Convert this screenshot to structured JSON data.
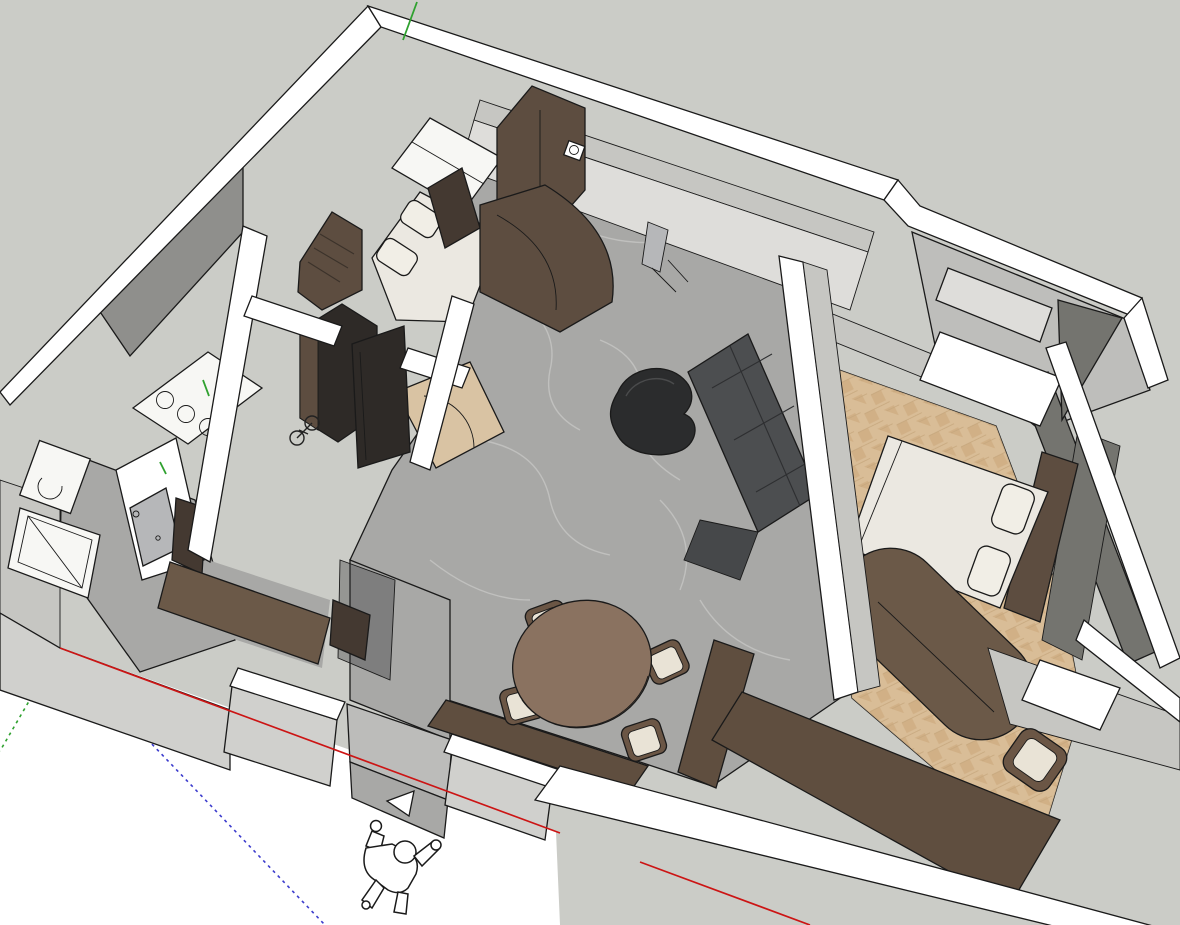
{
  "app": {
    "kind": "3d-modeling-viewport",
    "view": "top-down perspective of apartment interior model",
    "visible_text": ""
  },
  "palette": {
    "background": "#ffffff",
    "ground": "#cbccc7",
    "wallTop": "#ffffff",
    "wallFaceLight": "#deddda",
    "wallFaceMid": "#c6c6c2",
    "wallFaceShade": "#8f8f8c",
    "wallFaceDark": "#74746f",
    "wallFaceExt": "#d0d0cd",
    "marbleFloor": "#a8a8a6",
    "marbleVein": "#d8d8d6",
    "marbleStep": "#bcbcba",
    "woodFloor": "#d9bd97",
    "woodFloorAlt": "#cfae83",
    "vestibuleWood": "#d9c3a3",
    "darkWood": "#5d4d40",
    "darkWoodDeep": "#443931",
    "darkestWood": "#2e2a27",
    "counterWood": "#6b5948",
    "benchWood": "#5f4e3f",
    "sofaGray": "#4c4e50",
    "sofaShade": "#46484a",
    "coffeeTableDark": "#2b2c2d",
    "bedLinen": "#ebe8e1",
    "pillow": "#f1eee6",
    "tableWood": "#8a7260",
    "seatCream": "#e9e3d6",
    "chairFrame": "#6b5645",
    "doorGray": "#b6b7b9",
    "glassTint": "rgba(50,50,52,0.35)",
    "fixtureWhite": "#f7f7f4",
    "closetFloor": "#bebebb",
    "axisRed": "#cc1414",
    "axisGreen": "#2fa12f",
    "axisBlue": "#3c3ccd",
    "outline": "#1a1a1a"
  },
  "axes": {
    "origin": {
      "x": 60,
      "y": 648
    },
    "dash_pattern": "3 4",
    "red_solid": "positive X toward lower right",
    "red_dotted": "negative X toward upper left",
    "green_solid": "positive Y toward top",
    "green_dotted": "negative Y toward lower left",
    "blue_dotted": "negative Z toward lower right"
  },
  "scene": {
    "rooms": [
      "kids-bedroom",
      "entry-hall",
      "kitchen",
      "bathroom",
      "shower-room",
      "living-dining-room",
      "master-bedroom",
      "walk-in-closet",
      "desk-nook"
    ],
    "furniture": [
      "kids-bed",
      "kids-wardrobe",
      "kids-shelf",
      "kitchen-counter-cooktop",
      "tall-kitchen-unit",
      "bicycle",
      "hall-wardrobe",
      "curved-cabinet",
      "mirror",
      "ceiling-spotlight",
      "sofa",
      "coffee-table",
      "dining-table",
      "dining-chairs",
      "wall-bench",
      "double-bed",
      "pillows",
      "headboard",
      "pill-dresser",
      "desk",
      "desk-chair",
      "window-sill-box",
      "toilet",
      "shower-tray",
      "bathroom-door",
      "vanity-cabinet",
      "closet-cabinets",
      "scale-figure",
      "triangle-marker"
    ]
  }
}
